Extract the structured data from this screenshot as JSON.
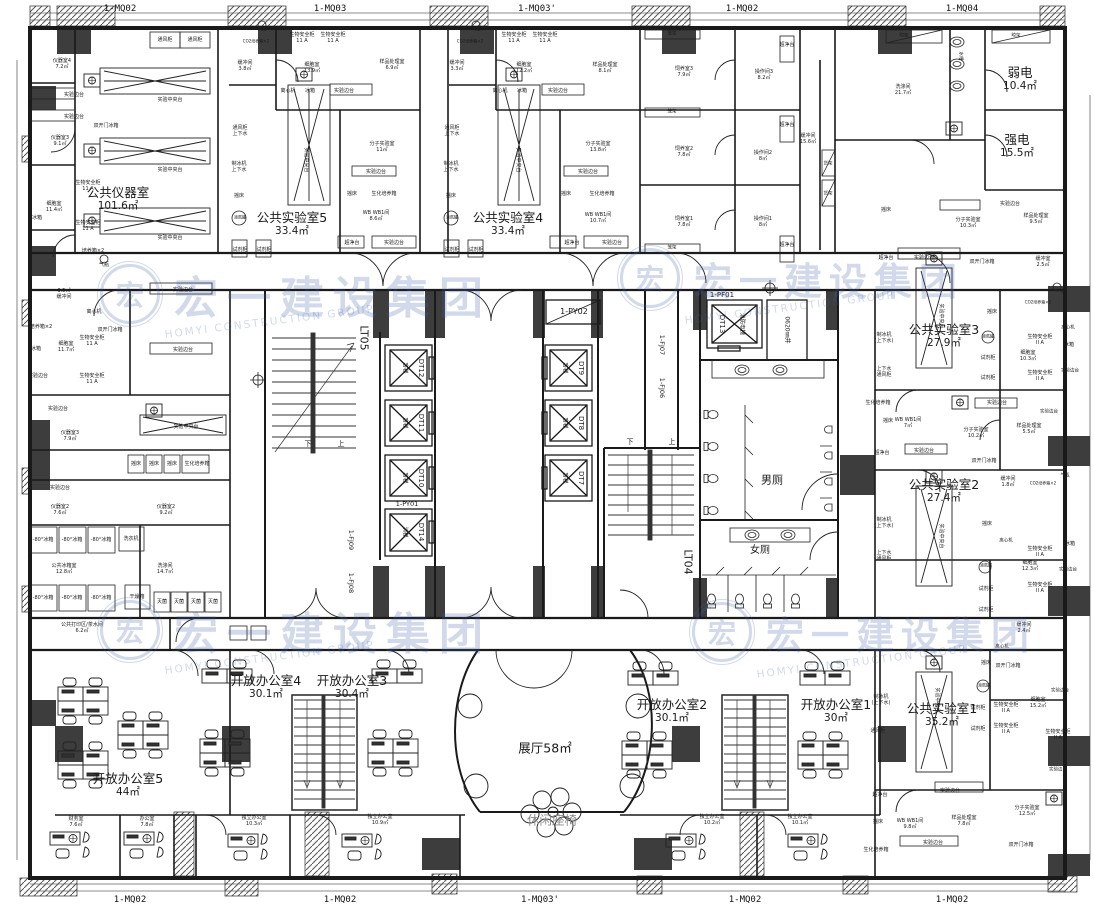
{
  "watermark": {
    "logo": "宏",
    "cn": "宏一建设集团",
    "en": "HOMYI CONSTRUCTION GROUP",
    "color": "#4468ad"
  },
  "mullions_top": [
    {
      "t": "1-MQ02",
      "x": 120
    },
    {
      "t": "1-MQ03",
      "x": 330
    },
    {
      "t": "1-MQ03'",
      "x": 537
    },
    {
      "t": "1-MQ02",
      "x": 742
    },
    {
      "t": "1-MQ04",
      "x": 962
    }
  ],
  "mullions_bottom": [
    {
      "t": "1-MQ02",
      "x": 130
    },
    {
      "t": "1-MQ02",
      "x": 340
    },
    {
      "t": "1-MQ03'",
      "x": 540
    },
    {
      "t": "1-MQ02",
      "x": 745
    },
    {
      "t": "1-MQ02",
      "x": 952
    }
  ],
  "rooms": [
    {
      "t": "公共仪器室",
      "a": "101.6㎡",
      "x": 118,
      "y": 199
    },
    {
      "t": "公共实验室5",
      "a": "33.4㎡",
      "x": 292,
      "y": 224
    },
    {
      "t": "公共实验室4",
      "a": "33.4㎡",
      "x": 508,
      "y": 224
    },
    {
      "t": "弱电",
      "a": "10.4㎡",
      "x": 1020,
      "y": 79
    },
    {
      "t": "强电",
      "a": "15.5㎡",
      "x": 1017,
      "y": 146
    },
    {
      "t": "公共实验室3",
      "a": "27.9㎡",
      "x": 944,
      "y": 336
    },
    {
      "t": "公共实验室2",
      "a": "27.4㎡",
      "x": 944,
      "y": 491
    },
    {
      "t": "公共实验室1",
      "a": "35.2㎡",
      "x": 942,
      "y": 715
    },
    {
      "t": "开放办公室5",
      "a": "44㎡",
      "x": 128,
      "y": 785
    },
    {
      "t": "开放办公室4",
      "a": "30.1㎡",
      "x": 266,
      "y": 687
    },
    {
      "t": "开放办公室3",
      "a": "30.4㎡",
      "x": 352,
      "y": 687
    },
    {
      "t": "开放办公室2",
      "a": "30.1㎡",
      "x": 672,
      "y": 711
    },
    {
      "t": "开放办公室1",
      "a": "30㎡",
      "x": 836,
      "y": 711
    },
    {
      "t": "展厅58㎡",
      "x": 545,
      "y": 748
    },
    {
      "t": "休闲座椅",
      "x": 552,
      "y": 820,
      "c": "muted"
    }
  ],
  "core": {
    "lt05": "LT05",
    "lt04": "LT04",
    "py02": "1-PY02",
    "py01": "1-PY01",
    "pf01": "1-PF01",
    "fj09": "1-FJ09",
    "fj08": "1-FJ08",
    "fj07": "1-FJ07",
    "fj06": "1-FJ06",
    "shaft_label": "0620㎜井",
    "down": "下",
    "up": "上",
    "men": "男厕",
    "women": "女厕",
    "elevators": [
      {
        "id": "DT12",
        "type": "客梯",
        "ix": 421,
        "iy": 368,
        "tx": 404,
        "ty": 368
      },
      {
        "id": "DT11",
        "type": "客梯",
        "ix": 421,
        "iy": 423,
        "tx": 404,
        "ty": 423
      },
      {
        "id": "DT10",
        "type": "客梯",
        "ix": 421,
        "iy": 478,
        "tx": 404,
        "ty": 478
      },
      {
        "id": "DT14",
        "type": "消梯",
        "ix": 421,
        "iy": 532,
        "tx": 404,
        "ty": 532
      },
      {
        "id": "DT9",
        "type": "客梯",
        "ix": 581,
        "iy": 368,
        "tx": 564,
        "ty": 368
      },
      {
        "id": "DT8",
        "type": "客梯",
        "ix": 581,
        "iy": 423,
        "tx": 564,
        "ty": 423
      },
      {
        "id": "DT7",
        "type": "客梯",
        "ix": 581,
        "iy": 478,
        "tx": 564,
        "ty": 478
      },
      {
        "id": "DT13",
        "type": "消防电梯",
        "ix": 722,
        "iy": 324,
        "tx": 741,
        "ty": 324
      }
    ]
  },
  "labels": [
    {
      "t": "通风柜",
      "x": 165,
      "y": 40
    },
    {
      "t": "通风柜",
      "x": 195,
      "y": 40
    },
    {
      "t": "仪器室4",
      "a": "7.2㎡",
      "x": 62,
      "y": 64
    },
    {
      "t": "实验边台",
      "x": 74,
      "y": 95
    },
    {
      "t": "实验边台",
      "x": 74,
      "y": 117
    },
    {
      "t": "仪器室3",
      "a": "9.1㎡",
      "x": 60,
      "y": 141
    },
    {
      "t": "实验中央台",
      "x": 170,
      "y": 100
    },
    {
      "t": "实验中央台",
      "x": 170,
      "y": 170
    },
    {
      "t": "实验中央台",
      "x": 170,
      "y": 238
    },
    {
      "t": "双开门冰箱",
      "x": 106,
      "y": 126
    },
    {
      "t": "生物安全柜",
      "a": "11 A",
      "x": 88,
      "y": 186
    },
    {
      "t": "细胞室",
      "a": "11.4㎡",
      "x": 54,
      "y": 207
    },
    {
      "t": "冰箱",
      "x": 37,
      "y": 218
    },
    {
      "t": "生物安全柜",
      "a": "11 A",
      "x": 88,
      "y": 226
    },
    {
      "t": "培养箱×2",
      "x": 93,
      "y": 251
    },
    {
      "t": "气瓶",
      "x": 104,
      "y": 265
    },
    {
      "t": "3.5㎡",
      "a": "缓冲间",
      "x": 64,
      "y": 294
    },
    {
      "t": "离心机",
      "x": 94,
      "y": 312
    },
    {
      "t": "培养箱×2",
      "x": 41,
      "y": 327
    },
    {
      "t": "细胞室",
      "a": "11.7㎡",
      "x": 66,
      "y": 347
    },
    {
      "t": "冰箱",
      "x": 36,
      "y": 349
    },
    {
      "t": "生物安全柜",
      "a": "11 A",
      "x": 92,
      "y": 341
    },
    {
      "t": "生物安全柜",
      "a": "11 A",
      "x": 92,
      "y": 379
    },
    {
      "t": "双开门冰箱",
      "x": 110,
      "y": 330
    },
    {
      "t": "实验边台",
      "x": 38,
      "y": 376
    },
    {
      "t": "实验边台",
      "x": 58,
      "y": 409
    },
    {
      "t": "仪器室3",
      "a": "7.9㎡",
      "x": 70,
      "y": 436
    },
    {
      "t": "摇床",
      "x": 136,
      "y": 464
    },
    {
      "t": "摇床",
      "x": 154,
      "y": 464
    },
    {
      "t": "摇床",
      "x": 172,
      "y": 464
    },
    {
      "t": "生化培养箱",
      "x": 197,
      "y": 464
    },
    {
      "t": "实验边台",
      "x": 60,
      "y": 488
    },
    {
      "t": "仪器室2",
      "a": "7.6㎡",
      "x": 60,
      "y": 510
    },
    {
      "t": "仪器室2",
      "a": "9.2㎡",
      "x": 166,
      "y": 510
    },
    {
      "t": "-80°冰箱",
      "x": 43,
      "y": 540
    },
    {
      "t": "-80°冰箱",
      "x": 72,
      "y": 540
    },
    {
      "t": "-80°冰箱",
      "x": 101,
      "y": 540
    },
    {
      "t": "洗衣机",
      "x": 131,
      "y": 539
    },
    {
      "t": "公共冰箱室",
      "a": "12.8㎡",
      "x": 64,
      "y": 569
    },
    {
      "t": "洗涤间",
      "a": "14.7㎡",
      "x": 165,
      "y": 569
    },
    {
      "t": "-80°冰箱",
      "x": 43,
      "y": 598
    },
    {
      "t": "-80°冰箱",
      "x": 72,
      "y": 598
    },
    {
      "t": "-80°冰箱",
      "x": 101,
      "y": 598
    },
    {
      "t": "干燥箱",
      "x": 137,
      "y": 597
    },
    {
      "t": "灭菌",
      "x": 162,
      "y": 602
    },
    {
      "t": "灭菌",
      "x": 179,
      "y": 602
    },
    {
      "t": "灭菌",
      "x": 196,
      "y": 602
    },
    {
      "t": "灭菌",
      "x": 213,
      "y": 602
    },
    {
      "t": "公共打印区/茶水间",
      "a": "6.2㎡",
      "x": 82,
      "y": 628
    },
    {
      "t": "气瓶",
      "x": 262,
      "y": 30,
      "fs": 4.5
    },
    {
      "t": "CO2培养箱×2",
      "x": 256,
      "y": 42,
      "fs": 4
    },
    {
      "t": "生物安全柜",
      "a": "11 A",
      "x": 302,
      "y": 38
    },
    {
      "t": "生物安全柜",
      "a": "11 A",
      "x": 333,
      "y": 38
    },
    {
      "t": "缓冲间",
      "a": "3.8㎡",
      "x": 245,
      "y": 66
    },
    {
      "t": "细胞室",
      "a": "13.9㎡",
      "x": 312,
      "y": 68
    },
    {
      "t": "离心机",
      "x": 288,
      "y": 91
    },
    {
      "t": "冰箱",
      "x": 310,
      "y": 91
    },
    {
      "t": "实验边台",
      "x": 344,
      "y": 91
    },
    {
      "t": "通风柜",
      "a": "上下水",
      "x": 240,
      "y": 131
    },
    {
      "t": "制冰机",
      "a": "上下水",
      "x": 239,
      "y": 167
    },
    {
      "t": "摇床",
      "x": 239,
      "y": 196
    },
    {
      "t": "液氮罐",
      "x": 240,
      "y": 218,
      "fs": 4
    },
    {
      "t": "试剂柜",
      "x": 240,
      "y": 250
    },
    {
      "t": "试剂柜",
      "x": 264,
      "y": 250
    },
    {
      "t": "实验中央台",
      "x": 306,
      "y": 160,
      "r": 90
    },
    {
      "t": "样品处理室",
      "a": "6.9㎡",
      "x": 392,
      "y": 65
    },
    {
      "t": "分子实验室",
      "a": "11㎡",
      "x": 382,
      "y": 147
    },
    {
      "t": "实验边台",
      "x": 376,
      "y": 172
    },
    {
      "t": "摇床",
      "x": 352,
      "y": 194
    },
    {
      "t": "生化培养箱",
      "x": 384,
      "y": 194
    },
    {
      "t": "WB WB1间",
      "a": "8.6㎡",
      "x": 376,
      "y": 216
    },
    {
      "t": "超净台",
      "x": 352,
      "y": 243
    },
    {
      "t": "实验边台",
      "x": 394,
      "y": 243
    },
    {
      "t": "气瓶",
      "x": 476,
      "y": 30,
      "fs": 4.5
    },
    {
      "t": "CO2培养箱×2",
      "x": 470,
      "y": 42,
      "fs": 4
    },
    {
      "t": "生物安全柜",
      "a": "11 A",
      "x": 514,
      "y": 38
    },
    {
      "t": "生物安全柜",
      "a": "11 A",
      "x": 545,
      "y": 38
    },
    {
      "t": "缓冲间",
      "a": "3.3㎡",
      "x": 457,
      "y": 66
    },
    {
      "t": "细胞室",
      "a": "12.2㎡",
      "x": 524,
      "y": 68
    },
    {
      "t": "离心机",
      "x": 500,
      "y": 91
    },
    {
      "t": "冰箱",
      "x": 522,
      "y": 91
    },
    {
      "t": "实验边台",
      "x": 558,
      "y": 91
    },
    {
      "t": "通风柜",
      "a": "上下水",
      "x": 452,
      "y": 131
    },
    {
      "t": "制冰机",
      "a": "上下水",
      "x": 451,
      "y": 167
    },
    {
      "t": "摇床",
      "x": 451,
      "y": 196
    },
    {
      "t": "液氮罐",
      "x": 452,
      "y": 218,
      "fs": 4
    },
    {
      "t": "试剂柜",
      "x": 452,
      "y": 250
    },
    {
      "t": "试剂柜",
      "x": 476,
      "y": 250
    },
    {
      "t": "实验中央台",
      "x": 518,
      "y": 160,
      "r": 90
    },
    {
      "t": "样品处理室",
      "a": "8.1㎡",
      "x": 605,
      "y": 68
    },
    {
      "t": "分子实验室",
      "a": "13.8㎡",
      "x": 598,
      "y": 147
    },
    {
      "t": "实验边台",
      "x": 588,
      "y": 172
    },
    {
      "t": "摇床",
      "x": 566,
      "y": 194
    },
    {
      "t": "生化培养箱",
      "x": 602,
      "y": 194
    },
    {
      "t": "WB WB1间",
      "a": "10.7㎡",
      "x": 598,
      "y": 218
    },
    {
      "t": "超净台",
      "x": 572,
      "y": 243
    },
    {
      "t": "实验边台",
      "x": 612,
      "y": 243
    },
    {
      "t": "笼架",
      "x": 672,
      "y": 34,
      "fs": 4.5
    },
    {
      "t": "笼架",
      "x": 672,
      "y": 112,
      "fs": 4.5
    },
    {
      "t": "笼架",
      "x": 672,
      "y": 248,
      "fs": 4.5
    },
    {
      "t": "饲养室3",
      "a": "7.9㎡",
      "x": 684,
      "y": 72
    },
    {
      "t": "操作间3",
      "a": "8.2㎡",
      "x": 764,
      "y": 75
    },
    {
      "t": "超净台",
      "x": 787,
      "y": 45
    },
    {
      "t": "饲养室2",
      "a": "7.8㎡",
      "x": 684,
      "y": 152
    },
    {
      "t": "操作间2",
      "a": "8㎡",
      "x": 763,
      "y": 156
    },
    {
      "t": "超净台",
      "x": 787,
      "y": 125
    },
    {
      "t": "饲养室1",
      "a": "7.8㎡",
      "x": 684,
      "y": 222
    },
    {
      "t": "操作间1",
      "a": "8㎡",
      "x": 763,
      "y": 222
    },
    {
      "t": "超净台",
      "x": 787,
      "y": 245
    },
    {
      "t": "缓冲间",
      "a": "15.6㎡",
      "x": 808,
      "y": 139
    },
    {
      "t": "货架",
      "x": 828,
      "y": 164,
      "fs": 4.5
    },
    {
      "t": "货架",
      "x": 828,
      "y": 194,
      "fs": 4.5
    },
    {
      "t": "洗涤间",
      "a": "21.7㎡",
      "x": 903,
      "y": 90
    },
    {
      "t": "水槽",
      "x": 960,
      "y": 56,
      "r": 90,
      "fs": 4.5
    },
    {
      "t": "晾架",
      "x": 904,
      "y": 36,
      "fs": 4.5
    },
    {
      "t": "晾架",
      "x": 1016,
      "y": 36,
      "fs": 4.5
    },
    {
      "t": "摇床",
      "x": 886,
      "y": 210
    },
    {
      "t": "超净台",
      "x": 886,
      "y": 258
    },
    {
      "t": "实验边台",
      "x": 924,
      "y": 258
    },
    {
      "t": "分子实验室",
      "a": "10.3㎡",
      "x": 968,
      "y": 223
    },
    {
      "t": "样品处理室",
      "a": "9.5㎡",
      "x": 1036,
      "y": 219
    },
    {
      "t": "缓冲室",
      "a": "2.5㎡",
      "x": 1043,
      "y": 262
    },
    {
      "t": "双开门冰箱",
      "x": 982,
      "y": 262
    },
    {
      "t": "实验边台",
      "x": 1010,
      "y": 204
    },
    {
      "t": "实验中央台",
      "x": 941,
      "y": 316,
      "r": 90
    },
    {
      "t": "制冰机",
      "a": "(上下水)",
      "x": 884,
      "y": 338
    },
    {
      "t": "上下水",
      "a": "通风柜",
      "x": 884,
      "y": 372
    },
    {
      "t": "摇床",
      "x": 992,
      "y": 312
    },
    {
      "t": "液氮罐",
      "x": 988,
      "y": 337,
      "fs": 4
    },
    {
      "t": "试剂柜",
      "x": 988,
      "y": 358
    },
    {
      "t": "试剂柜",
      "x": 988,
      "y": 378
    },
    {
      "t": "CO2培养箱×2",
      "x": 1038,
      "y": 303,
      "fs": 4
    },
    {
      "t": "气瓶",
      "x": 1062,
      "y": 292,
      "fs": 4.5
    },
    {
      "t": "生物安全柜",
      "a": "II A",
      "x": 1040,
      "y": 340
    },
    {
      "t": "生物安全柜",
      "a": "II A",
      "x": 1040,
      "y": 376
    },
    {
      "t": "细胞室",
      "a": "10.3㎡",
      "x": 1028,
      "y": 356
    },
    {
      "t": "离心机",
      "x": 1068,
      "y": 328,
      "fs": 4.5
    },
    {
      "t": "冰箱",
      "x": 1069,
      "y": 345
    },
    {
      "t": "实验边台",
      "x": 1070,
      "y": 371,
      "fs": 4.5
    },
    {
      "t": "生化培养箱",
      "x": 878,
      "y": 403
    },
    {
      "t": "摇床",
      "x": 888,
      "y": 421
    },
    {
      "t": "WB WB1间",
      "a": "7㎡",
      "x": 908,
      "y": 423
    },
    {
      "t": "超净台",
      "x": 882,
      "y": 453
    },
    {
      "t": "实验边台",
      "x": 924,
      "y": 451
    },
    {
      "t": "分子实验室",
      "a": "10.2㎡",
      "x": 976,
      "y": 433
    },
    {
      "t": "双开门冰箱",
      "x": 984,
      "y": 461
    },
    {
      "t": "样品处理室",
      "a": "5.5㎡",
      "x": 1029,
      "y": 429
    },
    {
      "t": "实验边台",
      "x": 1049,
      "y": 412,
      "fs": 4.5
    },
    {
      "t": "实验边台",
      "x": 997,
      "y": 403
    },
    {
      "t": "实验中央台",
      "x": 941,
      "y": 536,
      "r": 90
    },
    {
      "t": "制冰机",
      "a": "(上下水)",
      "x": 884,
      "y": 523
    },
    {
      "t": "上下水",
      "a": "通风柜",
      "x": 884,
      "y": 556
    },
    {
      "t": "缓冲间",
      "a": "1.8㎡",
      "x": 1008,
      "y": 482
    },
    {
      "t": "CO2培养箱×2",
      "x": 1043,
      "y": 484,
      "fs": 4
    },
    {
      "t": "气瓶",
      "x": 1065,
      "y": 476,
      "fs": 4.5
    },
    {
      "t": "摇床",
      "x": 987,
      "y": 524
    },
    {
      "t": "离心机",
      "x": 1006,
      "y": 541,
      "fs": 4.5
    },
    {
      "t": "液氮罐",
      "x": 986,
      "y": 566,
      "fs": 4
    },
    {
      "t": "生物安全柜",
      "a": "II A",
      "x": 1040,
      "y": 552
    },
    {
      "t": "生物安全柜",
      "a": "II A",
      "x": 1040,
      "y": 588
    },
    {
      "t": "试剂柜",
      "x": 986,
      "y": 589
    },
    {
      "t": "试剂柜",
      "x": 986,
      "y": 610
    },
    {
      "t": "细胞室",
      "a": "12.3㎡",
      "x": 1030,
      "y": 566
    },
    {
      "t": "冰箱",
      "x": 1070,
      "y": 544
    },
    {
      "t": "实验边台",
      "x": 1068,
      "y": 570,
      "fs": 4.5
    },
    {
      "t": "缓冲间",
      "a": "2.4㎡",
      "x": 1024,
      "y": 628
    },
    {
      "t": "离心机",
      "x": 1002,
      "y": 647,
      "fs": 4.5
    },
    {
      "t": "摇床",
      "x": 986,
      "y": 663
    },
    {
      "t": "双开门冰箱",
      "x": 1008,
      "y": 666
    },
    {
      "t": "液氮罐",
      "x": 984,
      "y": 686,
      "fs": 4
    },
    {
      "t": "试剂柜",
      "x": 978,
      "y": 708
    },
    {
      "t": "试剂柜",
      "x": 978,
      "y": 729
    },
    {
      "t": "生物安全柜",
      "a": "II A",
      "x": 1006,
      "y": 708
    },
    {
      "t": "生物安全柜",
      "a": "II A",
      "x": 1006,
      "y": 729
    },
    {
      "t": "细胞室",
      "a": "15.2㎡",
      "x": 1038,
      "y": 703
    },
    {
      "t": "实验边台",
      "x": 1060,
      "y": 691,
      "fs": 4.5
    },
    {
      "t": "生物安全柜",
      "a": "II A",
      "x": 1058,
      "y": 735
    },
    {
      "t": "实验边台",
      "x": 1058,
      "y": 770,
      "fs": 4.5
    },
    {
      "t": "实验中央台",
      "x": 937,
      "y": 700,
      "r": 90
    },
    {
      "t": "制冰机",
      "a": "(上下水)",
      "x": 881,
      "y": 700
    },
    {
      "t": "通风柜",
      "x": 878,
      "y": 731
    },
    {
      "t": "超净台",
      "x": 880,
      "y": 795
    },
    {
      "t": "摇床",
      "x": 878,
      "y": 822
    },
    {
      "t": "WB WB1间",
      "a": "9.8㎡",
      "x": 910,
      "y": 824
    },
    {
      "t": "生化培养箱",
      "x": 876,
      "y": 850
    },
    {
      "t": "实验边台",
      "x": 933,
      "y": 843
    },
    {
      "t": "样品处理室",
      "a": "7.8㎡",
      "x": 964,
      "y": 821
    },
    {
      "t": "实验边台",
      "x": 950,
      "y": 791
    },
    {
      "t": "分子实验室",
      "a": "12.5㎡",
      "x": 1027,
      "y": 811
    },
    {
      "t": "双开门冰箱",
      "x": 1021,
      "y": 845
    },
    {
      "t": "实验边台",
      "x": 183,
      "y": 290
    },
    {
      "t": "实验边台",
      "x": 183,
      "y": 350
    },
    {
      "t": "实验中央台",
      "x": 186,
      "y": 427
    },
    {
      "t": "财务室",
      "a": "7.6㎡",
      "x": 76,
      "y": 822
    },
    {
      "t": "办公室",
      "a": "7.8㎡",
      "x": 147,
      "y": 822
    },
    {
      "t": "独立办公室",
      "a": "10.3㎡",
      "x": 254,
      "y": 821
    },
    {
      "t": "独立办公室",
      "a": "10.9㎡",
      "x": 380,
      "y": 820
    },
    {
      "t": "独立办公室",
      "a": "10.2㎡",
      "x": 712,
      "y": 820
    },
    {
      "t": "独立办公室",
      "a": "10.1㎡",
      "x": 800,
      "y": 820
    }
  ]
}
